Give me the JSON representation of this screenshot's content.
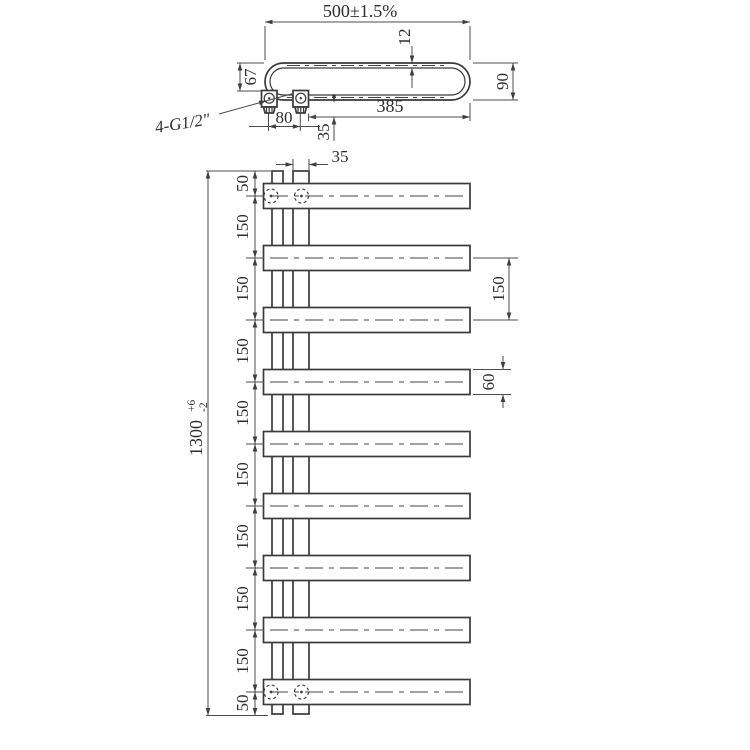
{
  "colors": {
    "line": "#3a3a3a",
    "dim_line": "#4d4d4d",
    "text": "#2e2e2e",
    "background": "#ffffff"
  },
  "top_view": {
    "overall_width": "500±1.5%",
    "tube_depth": "12",
    "left_offset": "67",
    "end_depth": "90",
    "straight_length": "385",
    "fitting_spacing": "80",
    "fitting_offset": "35",
    "thread_label": "4-G1/2″"
  },
  "front_view": {
    "riser_width": "35",
    "left_chain": [
      "50",
      "150",
      "150",
      "150",
      "150",
      "150",
      "150",
      "150",
      "150",
      "50"
    ],
    "overall_height": "1300",
    "overall_height_tol_upper": "+6",
    "overall_height_tol_lower": "-2",
    "right_bar_spacing": "150",
    "bar_width": "60"
  }
}
